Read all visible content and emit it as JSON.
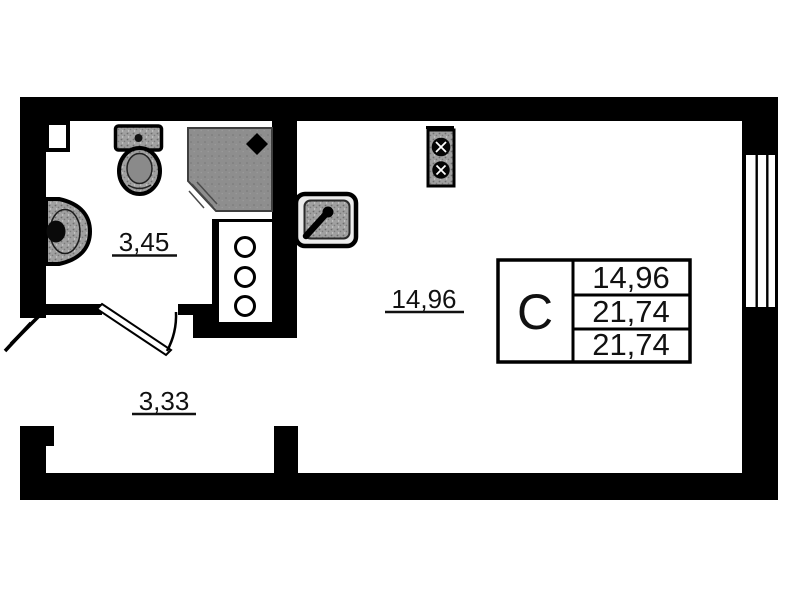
{
  "plan": {
    "legend": {
      "type_label": "С",
      "rows": [
        "14,96",
        "21,74",
        "21,74"
      ]
    },
    "rooms": {
      "bathroom": {
        "area": "3,45"
      },
      "living": {
        "area": "14,96"
      },
      "hall": {
        "area": "3,33"
      }
    },
    "icons": [
      "toilet-icon",
      "shower-cabin-icon",
      "wash-basin-icon",
      "kitchen-sink-icon",
      "stove-two-burner-icon",
      "riser-shaft-icon",
      "window-icon",
      "door-swing-icon",
      "entrance-door-icon"
    ],
    "colors": {
      "wall": "#000000",
      "background": "#ffffff",
      "fixture_gray": "#a0a0a0",
      "shower_gray": "#8e8e8e",
      "line": "#111111"
    }
  }
}
